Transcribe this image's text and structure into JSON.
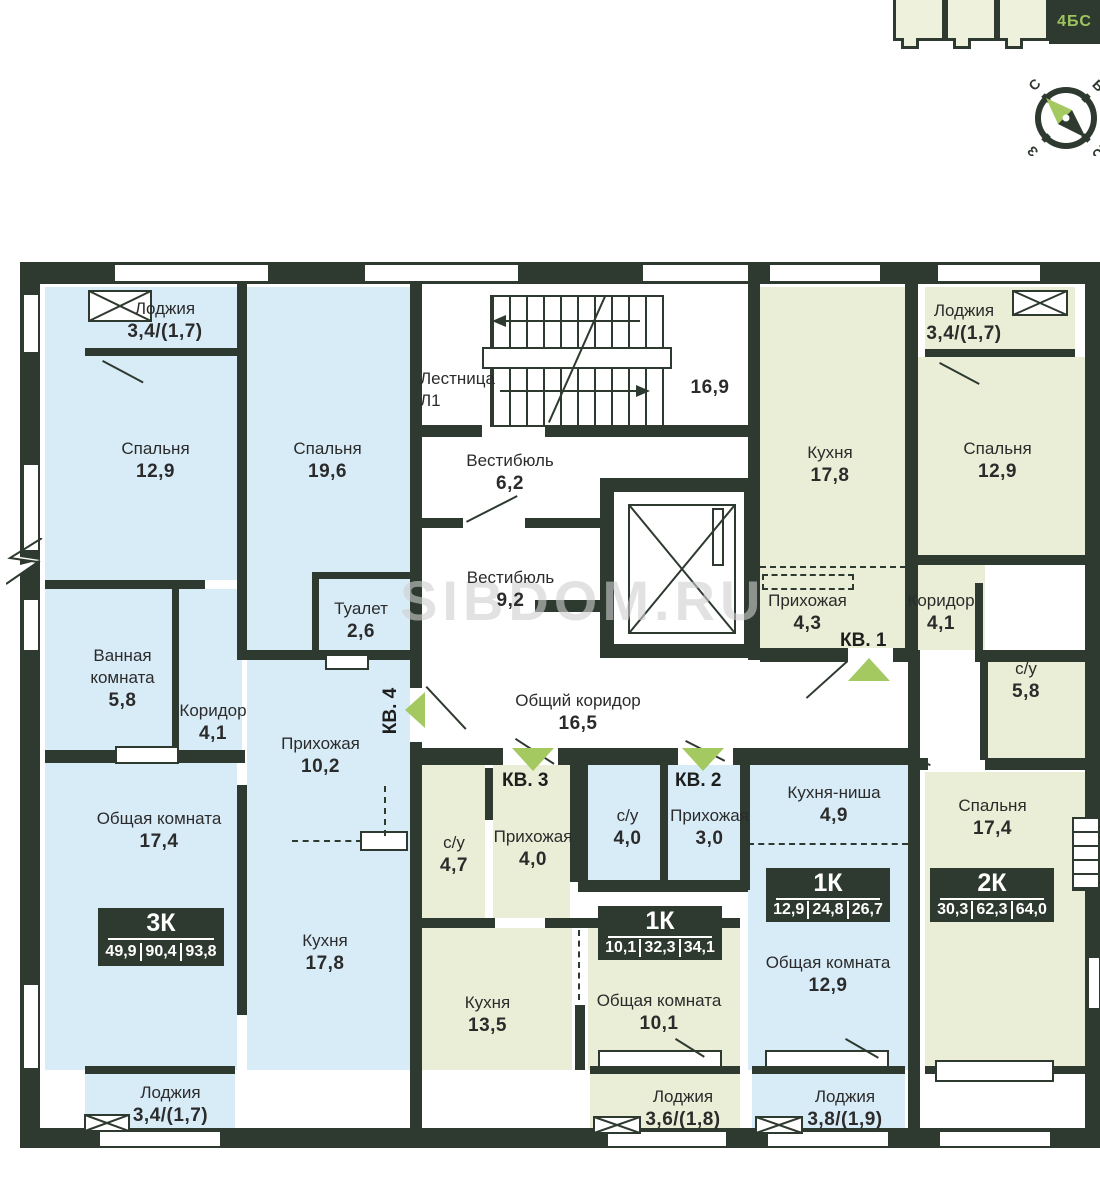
{
  "keyplan": {
    "active_label": "4БС"
  },
  "compass": {
    "north": "С",
    "east": "В",
    "west": "З",
    "south": "Ю"
  },
  "watermark": "SIBDOM.RU",
  "stairs": {
    "label": "Лестница",
    "id": "Л1",
    "area": "16,9"
  },
  "apartments": {
    "kv1": {
      "entry_label": "КВ. 1",
      "badge": {
        "type": "2К",
        "living": "30,3",
        "area": "62,3",
        "total": "64,0"
      }
    },
    "kv2": {
      "entry_label": "КВ. 2",
      "badge": {
        "type": "1К",
        "living": "12,9",
        "area": "24,8",
        "total": "26,7"
      }
    },
    "kv3": {
      "entry_label": "КВ. 3",
      "badge": {
        "type": "1К",
        "living": "10,1",
        "area": "32,3",
        "total": "34,1"
      }
    },
    "kv4": {
      "entry_label": "КВ. 4",
      "badge": {
        "type": "3К",
        "living": "49,9",
        "area": "90,4",
        "total": "93,8"
      }
    }
  },
  "rooms": {
    "loggia_tl": {
      "label": "Лоджия",
      "area": "3,4/(1,7)"
    },
    "bedroom_129_left": {
      "label": "Спальня",
      "area": "12,9"
    },
    "bedroom_196": {
      "label": "Спальня",
      "area": "19,6"
    },
    "bathroom": {
      "label": "Ванная комната",
      "area": "5,8"
    },
    "corridor_41_left": {
      "label": "Коридор",
      "area": "4,1"
    },
    "toilet": {
      "label": "Туалет",
      "area": "2,6"
    },
    "hallway_102": {
      "label": "Прихожая",
      "area": "10,2"
    },
    "living_174": {
      "label": "Общая комната",
      "area": "17,4"
    },
    "kitchen_178_left": {
      "label": "Кухня",
      "area": "17,8"
    },
    "loggia_bl": {
      "label": "Лоджия",
      "area": "3,4/(1,7)"
    },
    "vestibule_62": {
      "label": "Вестибюль",
      "area": "6,2"
    },
    "vestibule_92": {
      "label": "Вестибюль",
      "area": "9,2"
    },
    "common_corridor": {
      "label": "Общий коридор",
      "area": "16,5"
    },
    "kitchen_178_right": {
      "label": "Кухня",
      "area": "17,8"
    },
    "loggia_tr": {
      "label": "Лоджия",
      "area": "3,4/(1,7)"
    },
    "bedroom_129_right": {
      "label": "Спальня",
      "area": "12,9"
    },
    "hallway_43": {
      "label": "Прихожая",
      "area": "4,3"
    },
    "corridor_41_right": {
      "label": "Коридор",
      "area": "4,1"
    },
    "su_58": {
      "label": "с/у",
      "area": "5,8"
    },
    "bedroom_174": {
      "label": "Спальня",
      "area": "17,4"
    },
    "su_40": {
      "label": "с/у",
      "area": "4,0"
    },
    "hallway_30": {
      "label": "Прихожая",
      "area": "3,0"
    },
    "kitchen_niche": {
      "label": "Кухня-ниша",
      "area": "4,9"
    },
    "living_129": {
      "label": "Общая комната",
      "area": "12,9"
    },
    "loggia_38": {
      "label": "Лоджия",
      "area": "3,8/(1,9)"
    },
    "su_47": {
      "label": "с/у",
      "area": "4,7"
    },
    "hallway_40": {
      "label": "Прихожая",
      "area": "4,0"
    },
    "kitchen_135": {
      "label": "Кухня",
      "area": "13,5"
    },
    "living_101": {
      "label": "Общая комната",
      "area": "10,1"
    },
    "loggia_36": {
      "label": "Лоджия",
      "area": "3,6/(1,8)"
    }
  }
}
